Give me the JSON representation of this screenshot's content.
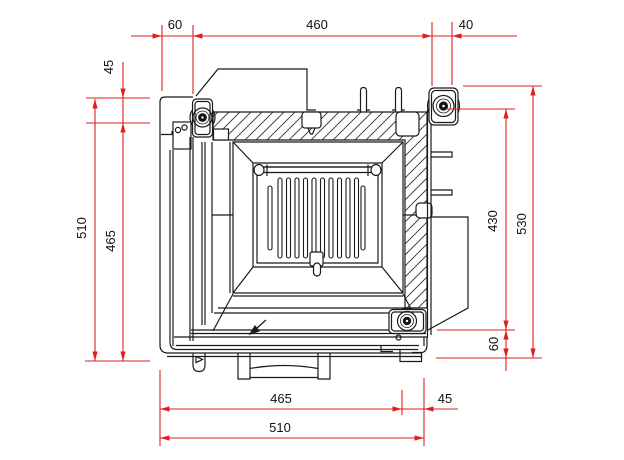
{
  "drawing": {
    "kind": "technical-section-top-view",
    "colors": {
      "line": "#1a1a1a",
      "dimension": "#dd1f1f",
      "background": "#ffffff"
    }
  },
  "dimensions": {
    "top": [
      {
        "value": "60"
      },
      {
        "value": "460"
      },
      {
        "value": "40"
      }
    ],
    "left": [
      {
        "value": "45"
      },
      {
        "value": "510"
      },
      {
        "value": "465"
      }
    ],
    "right": [
      {
        "value": "430"
      },
      {
        "value": "530"
      },
      {
        "value": "60"
      }
    ],
    "bottom": [
      {
        "value": "465"
      },
      {
        "value": "45"
      },
      {
        "value": "510"
      }
    ]
  }
}
